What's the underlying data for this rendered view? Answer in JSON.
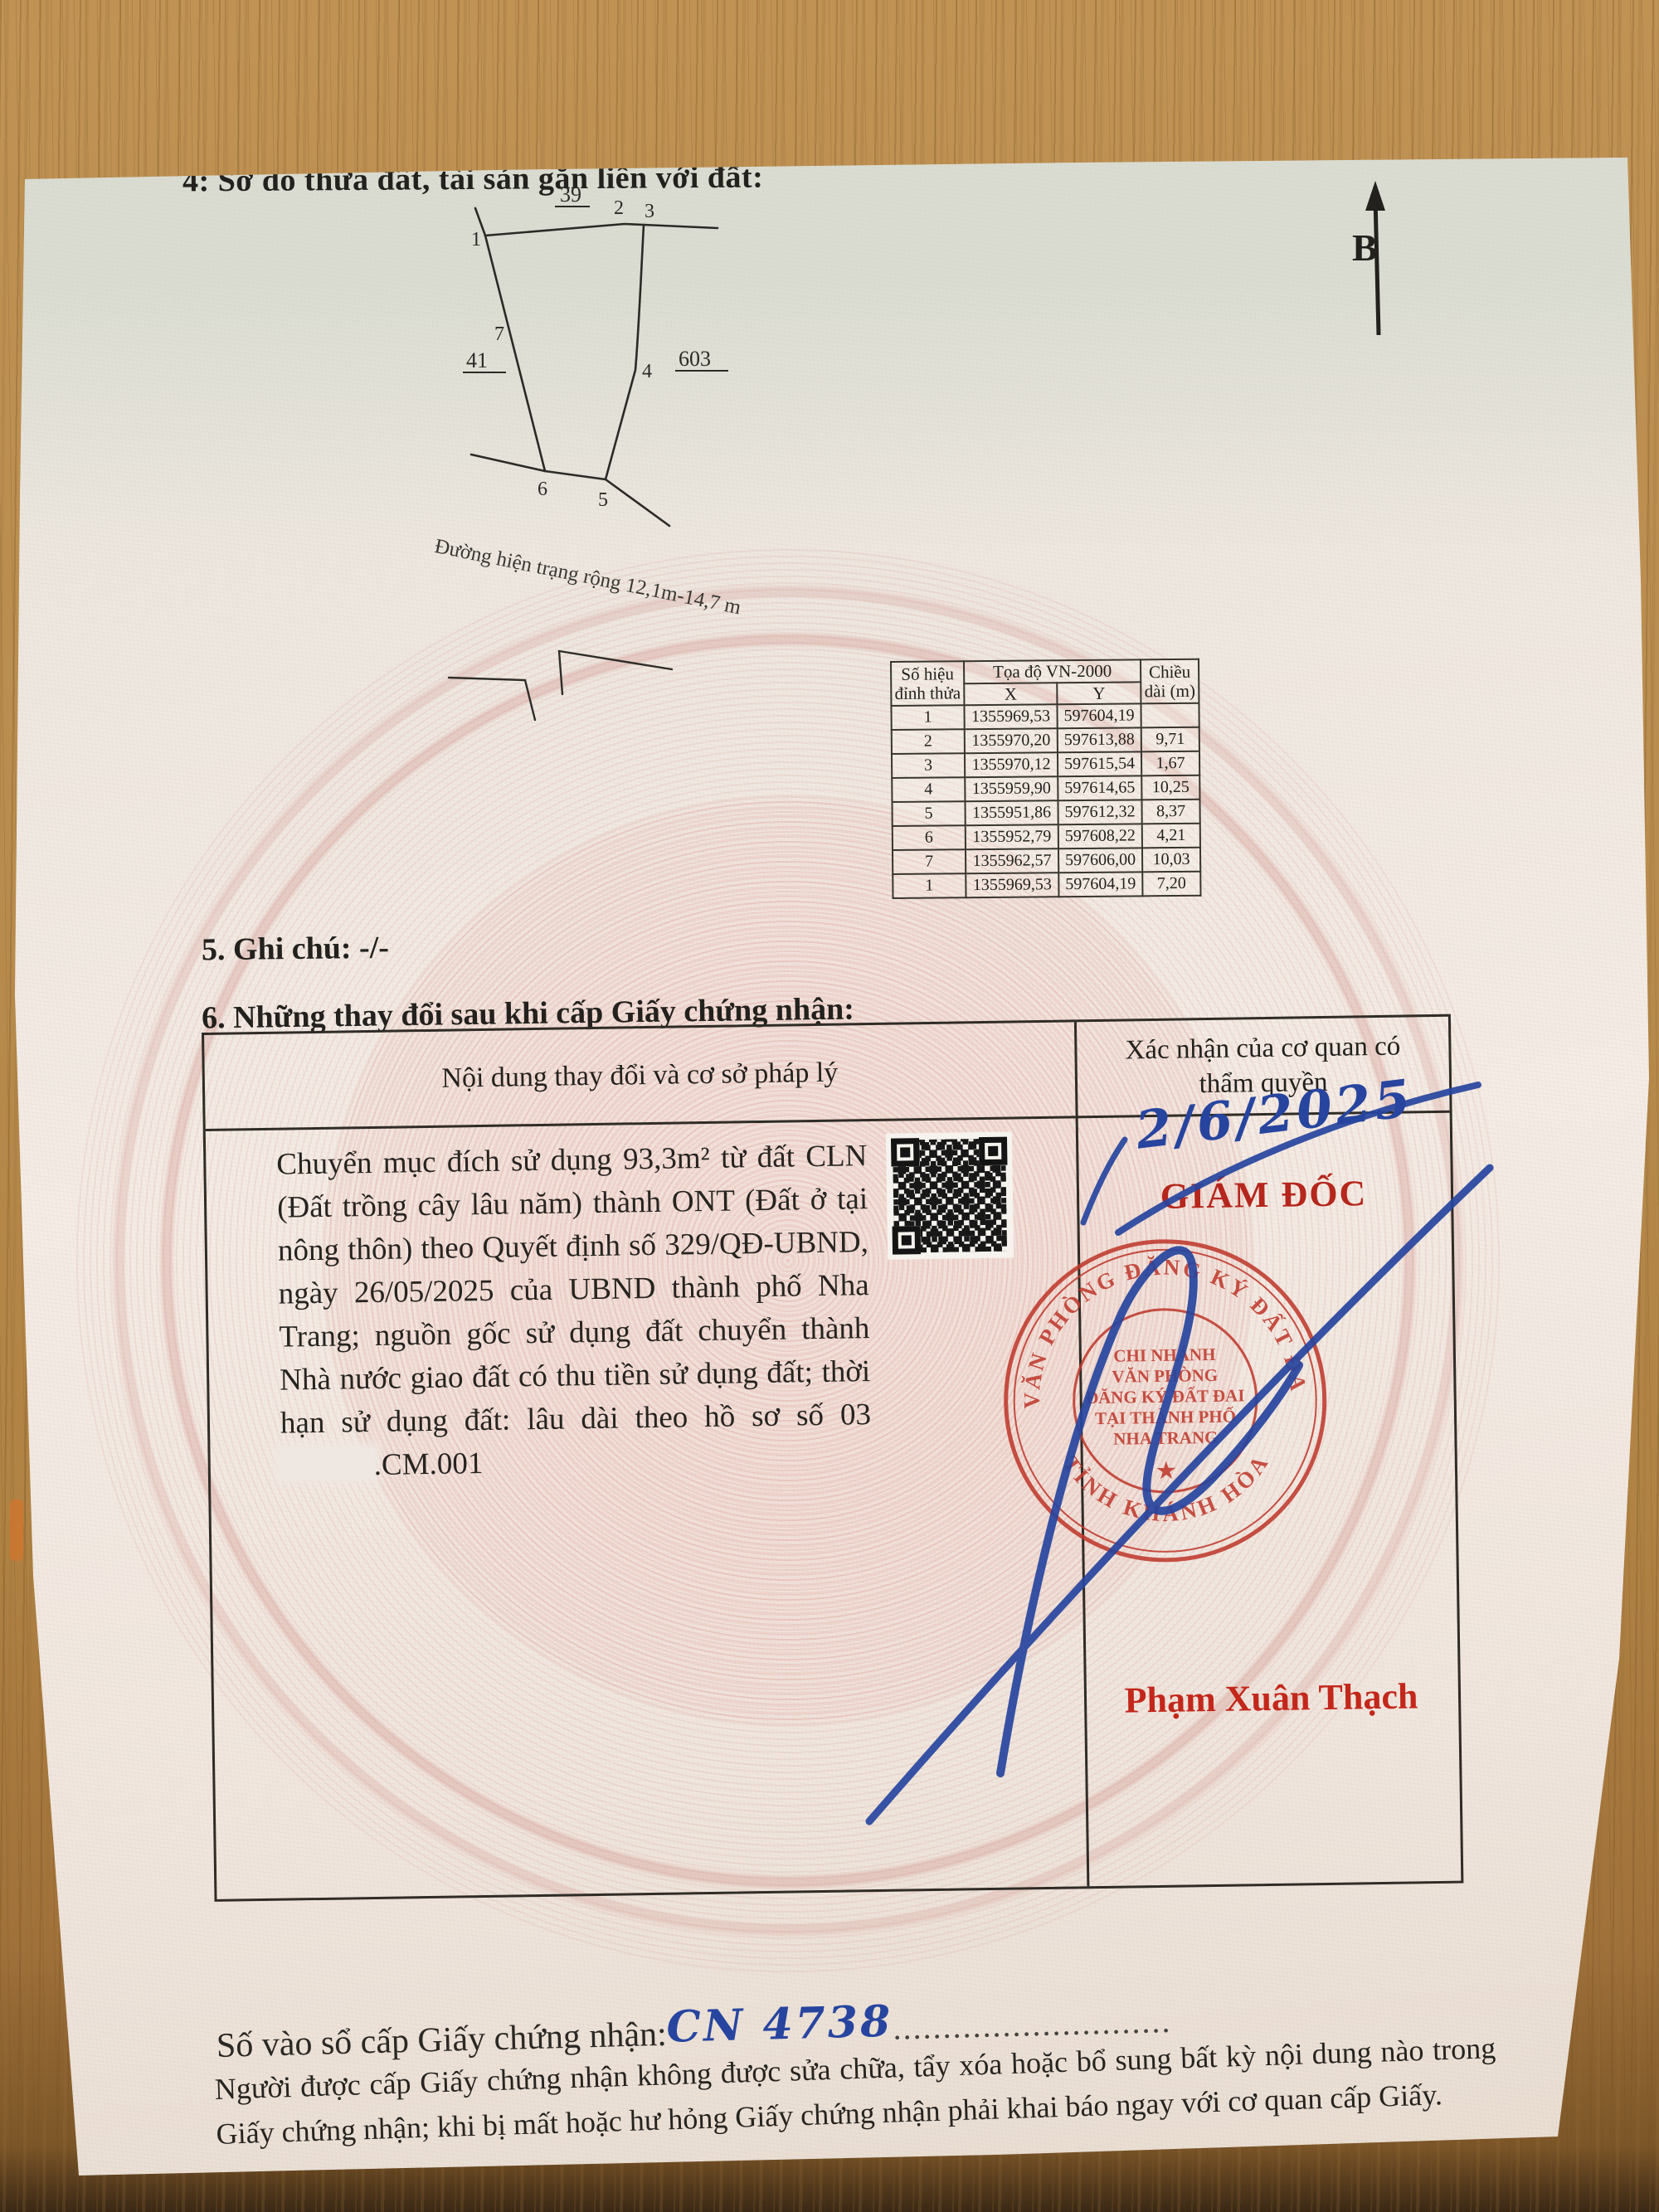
{
  "page": {
    "section4_title": "4: Sơ đồ thửa đất, tài sản gắn liền với đất:",
    "section5_text": "5. Ghi chú: -/-",
    "section6_title": "6. Những thay đổi sau khi cấp Giấy chứng nhận:"
  },
  "diagram": {
    "north_label": "B",
    "road_label": "Đường hiện trạng rộng 12,1m-14,7 m",
    "adjacent_parcels": {
      "top": "39",
      "left": "41",
      "right": "603"
    },
    "vertex_labels": [
      "1",
      "2",
      "3",
      "4",
      "5",
      "6",
      "7"
    ]
  },
  "coord_table": {
    "header": {
      "vertex": "Số hiệu đỉnh thửa",
      "coords": "Tọa độ VN-2000",
      "x": "X",
      "y": "Y",
      "length": "Chiều dài (m)"
    },
    "rows": [
      {
        "v": "1",
        "x": "1355969,53",
        "y": "597604,19",
        "d": ""
      },
      {
        "v": "2",
        "x": "1355970,20",
        "y": "597613,88",
        "d": "9,71"
      },
      {
        "v": "3",
        "x": "1355970,12",
        "y": "597615,54",
        "d": "1,67"
      },
      {
        "v": "4",
        "x": "1355959,90",
        "y": "597614,65",
        "d": "10,25"
      },
      {
        "v": "5",
        "x": "1355951,86",
        "y": "597612,32",
        "d": "8,37"
      },
      {
        "v": "6",
        "x": "1355952,79",
        "y": "597608,22",
        "d": "4,21"
      },
      {
        "v": "7",
        "x": "1355962,57",
        "y": "597606,00",
        "d": "10,03"
      },
      {
        "v": "1",
        "x": "1355969,53",
        "y": "597604,19",
        "d": "7,20"
      }
    ]
  },
  "change_table": {
    "col1_header": "Nội dung thay đổi và cơ sở pháp lý",
    "col2_header": "Xác nhận của cơ quan có thẩm quyền",
    "content_before_gap": "Chuyển mục đích sử dụng 93,3m² từ đất CLN (Đất trồng cây lâu năm) thành ONT (Đất ở tại nông thôn) theo Quyết định số 329/QĐ-UBND, ngày 26/05/2025 của UBND thành phố Nha Trang; nguồn gốc sử dụng đất chuyển thành Nhà nước giao đất có thu tiền sử dụng đất; thời hạn sử dụng đất: lâu dài theo hồ sơ số 03",
    "content_after_gap": ".CM.001"
  },
  "approval": {
    "handwritten_date": "2/6/2025",
    "title": "GIÁM ĐỐC",
    "signer_name": "Phạm Xuân Thạch",
    "stamp": {
      "outer_top": "VĂN PHÒNG ĐĂNG KÝ ĐẤT ĐAI",
      "outer_bottom": "TỈNH KHÁNH HÒA",
      "inner_lines": [
        "CHI NHÁNH",
        "VĂN PHÒNG",
        "ĐĂNG KÝ ĐẤT ĐAI",
        "TẠI THÀNH PHỐ",
        "NHA TRANG"
      ],
      "star": "★"
    }
  },
  "footer": {
    "registry_label": "Số vào sổ cấp Giấy chứng nhận:",
    "registry_value": "CN 4738",
    "dots": "............................",
    "notice": "Người được cấp Giấy chứng nhận không được sửa chữa, tẩy xóa hoặc bổ sung bất kỳ nội dung nào trong Giấy chứng nhận; khi bị mất hoặc hư hỏng Giấy chứng nhận phải khai báo ngay với cơ quan cấp Giấy."
  },
  "colors": {
    "stamp_red": "#bf3a2e",
    "ink_blue": "#27459f",
    "paper": "#f0e8e1",
    "wood": "#b98d4f"
  }
}
